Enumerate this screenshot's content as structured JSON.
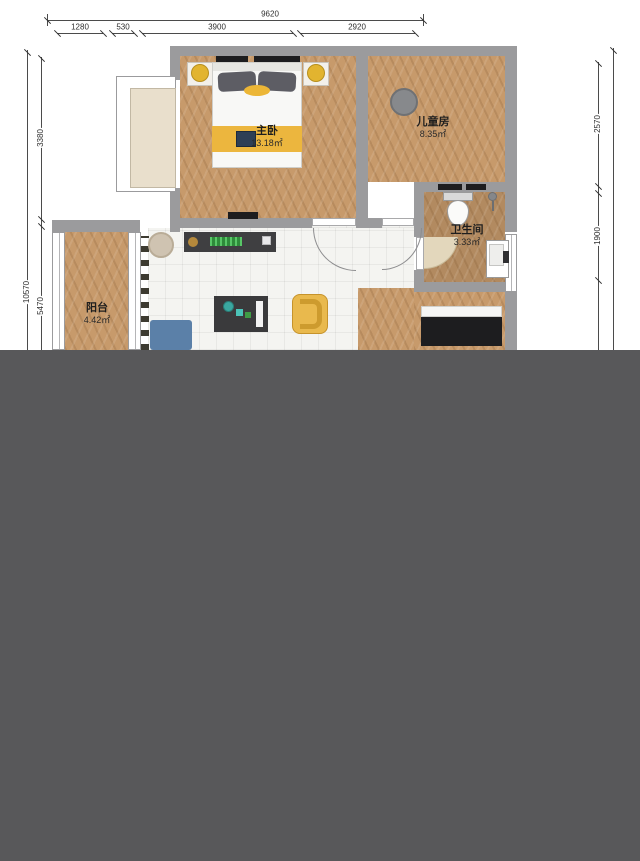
{
  "dimensions": {
    "top_total": "9620",
    "top_segments": [
      "1280",
      "530",
      "3900",
      "2920"
    ],
    "left_total": "10570",
    "left_segments": [
      "3380",
      "5470"
    ],
    "right_segments": [
      "2570",
      "1900"
    ]
  },
  "rooms": [
    {
      "name": "主卧",
      "area": "13.18㎡"
    },
    {
      "name": "儿童房",
      "area": "8.35㎡"
    },
    {
      "name": "卫生间",
      "area": "3.33㎡"
    },
    {
      "name": "阳台",
      "area": "4.42㎡"
    }
  ],
  "colors": {
    "overlay_gray": "#58585a",
    "wall_gray": "#9b9b9d",
    "wood_floor": "#c79a6b",
    "bath_floor": "#b28a60",
    "tile_floor": "#f4f4f1",
    "accent_yellow": "#e9b94d",
    "bed_yellow_band": "#ecb63e",
    "sofa_blue": "#5b80a8",
    "console_dark": "#3f3f41",
    "plant_green": "#2e8c3a",
    "door_swing_beige": "#e3d7bc",
    "rug_beige": "#cfc3b1",
    "rug_gray": "#87898c"
  }
}
